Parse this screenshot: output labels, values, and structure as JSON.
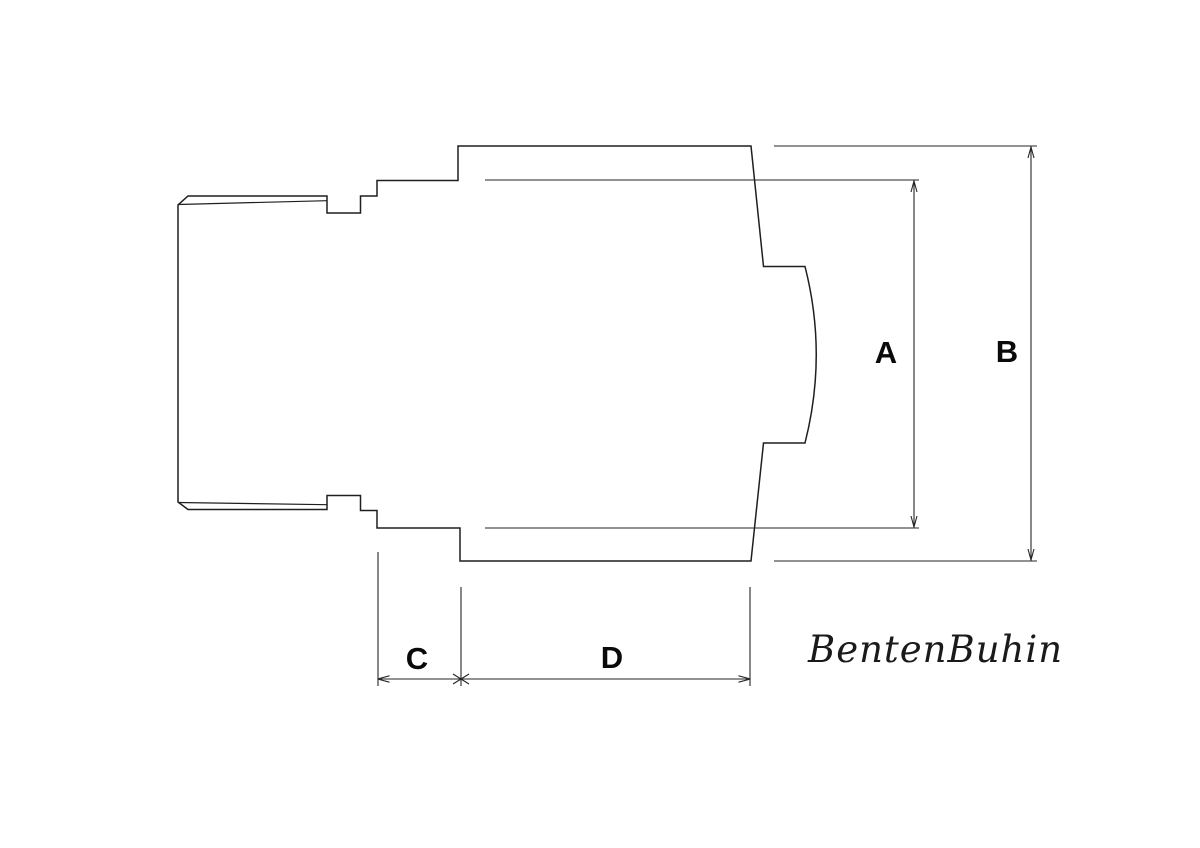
{
  "drawing": {
    "type": "technical-drawing",
    "background_color": "#ffffff",
    "line_color": "#1f1f1f",
    "label_color": "#0a0a0a"
  },
  "dimensions": {
    "a": {
      "label": "A",
      "orientation": "vertical"
    },
    "b": {
      "label": "B",
      "orientation": "vertical"
    },
    "c": {
      "label": "C",
      "orientation": "horizontal"
    },
    "d": {
      "label": "D",
      "orientation": "horizontal"
    }
  },
  "signature": {
    "text": "BentenBuhin"
  }
}
